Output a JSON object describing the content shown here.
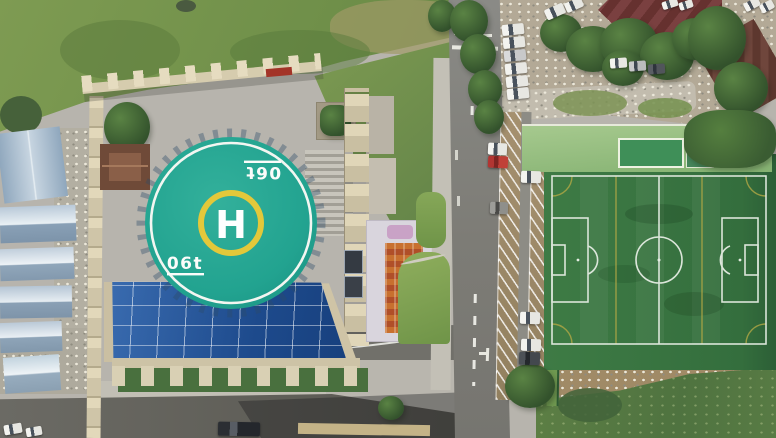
{
  "scene": {
    "title": "Aerial drone view — rooftop helipad beside campus road and soccer field",
    "description": "Top-down photo: circular teal rooftop helipad on a building with blue glass atrium roof, angled roadside parking with cars, artificial-turf soccer field, gravel car lot with trees, surrounding grass, dirt and sheds."
  },
  "helipad": {
    "letter": "H",
    "weight_limit": "06t",
    "weight_limit_rotated": "06t",
    "pad_color": "#22a390",
    "h_ring_color": "#e3c83a",
    "ring_color": "#f2f6f1"
  },
  "soccer_field": {
    "turf_color": "#3e7b45",
    "line_color": "#e4ece2",
    "accent_line_color": "#b2a845"
  },
  "palette": {
    "pavement": "#b7b4ad",
    "asphalt": "#7d7c76",
    "glass_roof": "#2a5ca4",
    "shed_roof": "#9fb3c8",
    "grass": "#7e9b52",
    "dirt": "#a08a66",
    "maroon_roof": "#6e3c3c"
  },
  "vehicles": {
    "white_cars": 16,
    "red_cars": 1,
    "gray_cars": 3
  }
}
